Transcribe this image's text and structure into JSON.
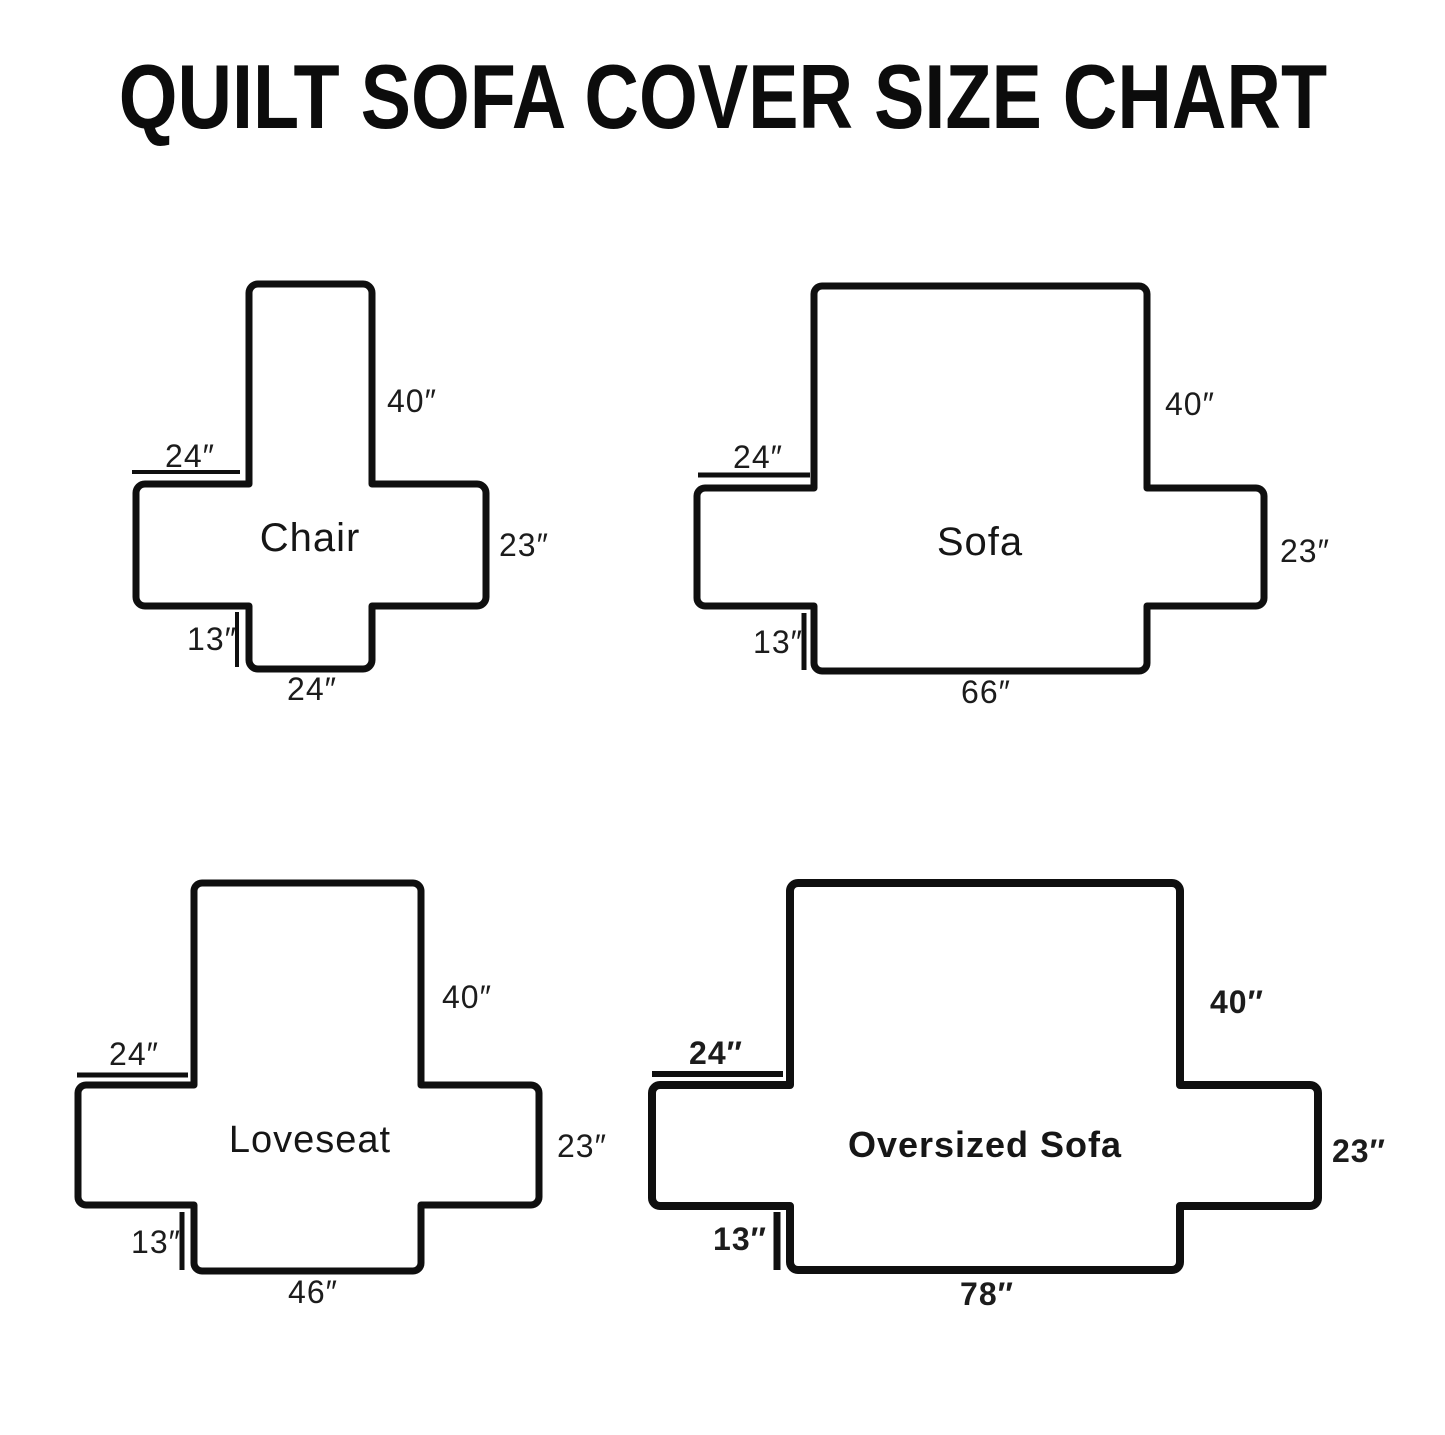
{
  "title": "QUILT SOFA COVER SIZE CHART",
  "colors": {
    "ink": "#0f0f0f",
    "text": "#1c1c1c",
    "background": "#ffffff"
  },
  "diagrams": [
    {
      "name": "Chair",
      "back_height": "40″",
      "arm_length": "24″",
      "side_height": "23″",
      "skirt_height": "13″",
      "seat_width": "24″"
    },
    {
      "name": "Sofa",
      "back_height": "40″",
      "arm_length": "24″",
      "side_height": "23″",
      "skirt_height": "13″",
      "seat_width": "66″"
    },
    {
      "name": "Loveseat",
      "back_height": "40″",
      "arm_length": "24″",
      "side_height": "23″",
      "skirt_height": "13″",
      "seat_width": "46″"
    },
    {
      "name": "Oversized Sofa",
      "back_height": "40″",
      "arm_length": "24″",
      "side_height": "23″",
      "skirt_height": "13″",
      "seat_width": "78″"
    }
  ]
}
